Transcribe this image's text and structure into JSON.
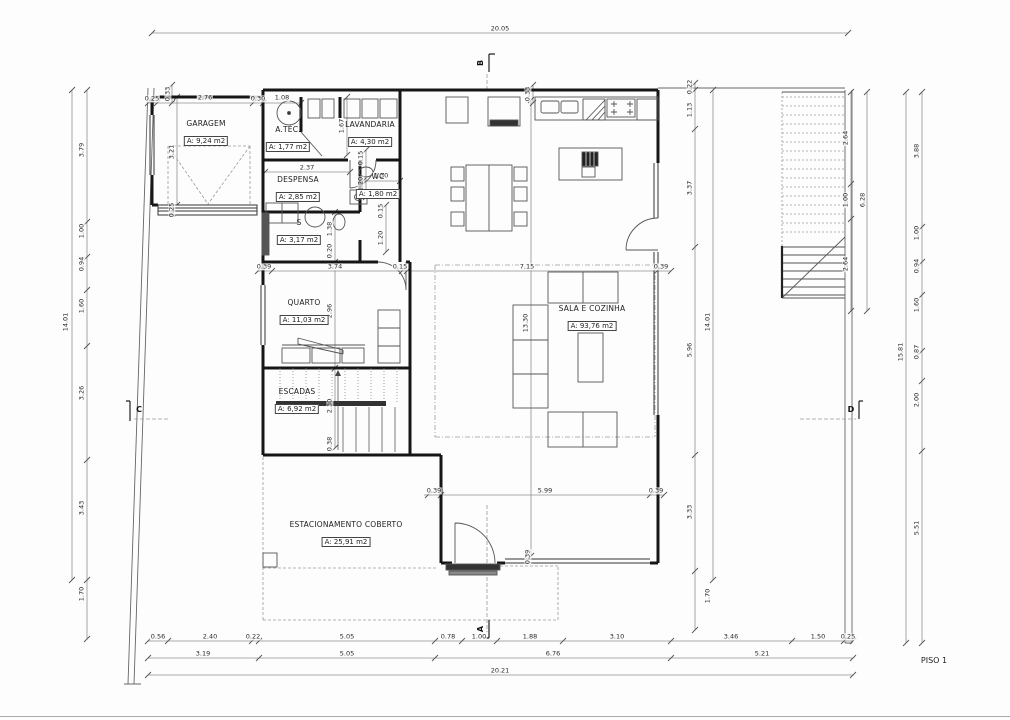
{
  "sheet": {
    "title": "PISO 1"
  },
  "drawing": {
    "rooms": [
      {
        "name": "GARAGEM",
        "area": "A: 9,24 m2",
        "x": 206,
        "y": 133
      },
      {
        "name": "A.TÉC.",
        "area": "A: 1,77 m2",
        "x": 288,
        "y": 139
      },
      {
        "name": "LAVANDARIA",
        "area": "A: 4,30 m2",
        "x": 370,
        "y": 134
      },
      {
        "name": "DESPENSA",
        "area": "A: 2,85 m2",
        "x": 298,
        "y": 189
      },
      {
        "name": "WC",
        "area": "A: 1,80 m2",
        "x": 378,
        "y": 186
      },
      {
        "name": "S",
        "area": "A: 3,17 m2",
        "x": 299,
        "y": 232
      },
      {
        "name": "QUARTO",
        "area": "A: 11,03 m2",
        "x": 304,
        "y": 312
      },
      {
        "name": "ESCADAS",
        "area": "A: 6,92 m2",
        "x": 297,
        "y": 401
      },
      {
        "name": "SALA E COZINHA",
        "area": "A: 93,76 m2",
        "x": 592,
        "y": 318
      },
      {
        "name": "ESTACIONAMENTO COBERTO",
        "area": "A: 25,91 m2",
        "x": 346,
        "y": 534
      }
    ],
    "dimensions": [
      {
        "t": "20.05",
        "x": 500,
        "y": 29
      },
      {
        "t": "0.25",
        "x": 152,
        "y": 99
      },
      {
        "t": "2.76",
        "x": 205,
        "y": 98
      },
      {
        "t": "0.30",
        "x": 258,
        "y": 99
      },
      {
        "t": "1.08",
        "x": 282,
        "y": 98
      },
      {
        "t": "0.33",
        "x": 168,
        "y": 94,
        "v": 1
      },
      {
        "t": "0.33",
        "x": 528,
        "y": 94,
        "v": 1
      },
      {
        "t": "0.22",
        "x": 690,
        "y": 87,
        "v": 1
      },
      {
        "t": "1.13",
        "x": 690,
        "y": 110,
        "v": 1
      },
      {
        "t": "3.37",
        "x": 690,
        "y": 188,
        "v": 1
      },
      {
        "t": "3.21",
        "x": 172,
        "y": 152,
        "v": 1
      },
      {
        "t": "0.25",
        "x": 172,
        "y": 210,
        "v": 1
      },
      {
        "t": "1.67",
        "x": 342,
        "y": 126,
        "v": 1
      },
      {
        "t": "2.37",
        "x": 307,
        "y": 168
      },
      {
        "t": "1.30",
        "x": 381,
        "y": 176
      },
      {
        "t": "0.15",
        "x": 361,
        "y": 158,
        "v": 1
      },
      {
        "t": "1.20",
        "x": 361,
        "y": 184,
        "v": 1
      },
      {
        "t": "0.15",
        "x": 381,
        "y": 211,
        "v": 1
      },
      {
        "t": "1.20",
        "x": 381,
        "y": 238,
        "v": 1
      },
      {
        "t": "1.38",
        "x": 330,
        "y": 229,
        "v": 1
      },
      {
        "t": "0.20",
        "x": 330,
        "y": 251,
        "v": 1
      },
      {
        "t": "0.39",
        "x": 264,
        "y": 267
      },
      {
        "t": "3.74",
        "x": 335,
        "y": 267
      },
      {
        "t": "0.15",
        "x": 400,
        "y": 267
      },
      {
        "t": "7.15",
        "x": 527,
        "y": 267
      },
      {
        "t": "0.39",
        "x": 661,
        "y": 267
      },
      {
        "t": "2.96",
        "x": 330,
        "y": 311,
        "v": 1
      },
      {
        "t": "13.30",
        "x": 526,
        "y": 323,
        "v": 1
      },
      {
        "t": "5.96",
        "x": 690,
        "y": 350,
        "v": 1
      },
      {
        "t": "14.01",
        "x": 708,
        "y": 322,
        "v": 1
      },
      {
        "t": "2.64",
        "x": 846,
        "y": 138,
        "v": 1
      },
      {
        "t": "1.00",
        "x": 846,
        "y": 200,
        "v": 1
      },
      {
        "t": "2.64",
        "x": 846,
        "y": 264,
        "v": 1
      },
      {
        "t": "6.28",
        "x": 863,
        "y": 200,
        "v": 1
      },
      {
        "t": "2.30",
        "x": 330,
        "y": 406,
        "v": 1
      },
      {
        "t": "0.38",
        "x": 330,
        "y": 444,
        "v": 1
      },
      {
        "t": "0.39",
        "x": 434,
        "y": 491
      },
      {
        "t": "5.99",
        "x": 545,
        "y": 491
      },
      {
        "t": "0.39",
        "x": 656,
        "y": 491
      },
      {
        "t": "0.39",
        "x": 528,
        "y": 557,
        "v": 1
      },
      {
        "t": "3.33",
        "x": 690,
        "y": 512,
        "v": 1
      },
      {
        "t": "1.70",
        "x": 708,
        "y": 596,
        "v": 1
      },
      {
        "t": "3.79",
        "x": 82,
        "y": 150,
        "v": 1
      },
      {
        "t": "1.00",
        "x": 82,
        "y": 231,
        "v": 1
      },
      {
        "t": "0.94",
        "x": 82,
        "y": 264,
        "v": 1
      },
      {
        "t": "1.60",
        "x": 82,
        "y": 306,
        "v": 1
      },
      {
        "t": "3.26",
        "x": 82,
        "y": 393,
        "v": 1
      },
      {
        "t": "3.43",
        "x": 82,
        "y": 508,
        "v": 1
      },
      {
        "t": "1.70",
        "x": 82,
        "y": 594,
        "v": 1
      },
      {
        "t": "14.01",
        "x": 66,
        "y": 322,
        "v": 1
      },
      {
        "t": "3.88",
        "x": 917,
        "y": 151,
        "v": 1
      },
      {
        "t": "1.00",
        "x": 917,
        "y": 233,
        "v": 1
      },
      {
        "t": "0.94",
        "x": 917,
        "y": 266,
        "v": 1
      },
      {
        "t": "1.60",
        "x": 917,
        "y": 305,
        "v": 1
      },
      {
        "t": "0.87",
        "x": 917,
        "y": 352,
        "v": 1
      },
      {
        "t": "2.00",
        "x": 917,
        "y": 400,
        "v": 1
      },
      {
        "t": "5.51",
        "x": 917,
        "y": 528,
        "v": 1
      },
      {
        "t": "15.81",
        "x": 901,
        "y": 352,
        "v": 1
      },
      {
        "t": "0.56",
        "x": 158,
        "y": 637
      },
      {
        "t": "2.40",
        "x": 210,
        "y": 637
      },
      {
        "t": "0.22",
        "x": 253,
        "y": 637
      },
      {
        "t": "5.05",
        "x": 347,
        "y": 637
      },
      {
        "t": "0.78",
        "x": 448,
        "y": 637
      },
      {
        "t": "1.00",
        "x": 479,
        "y": 637
      },
      {
        "t": "1.88",
        "x": 530,
        "y": 637
      },
      {
        "t": "3.10",
        "x": 617,
        "y": 637
      },
      {
        "t": "3.46",
        "x": 731,
        "y": 637
      },
      {
        "t": "1.50",
        "x": 818,
        "y": 637
      },
      {
        "t": "0.25",
        "x": 848,
        "y": 637
      },
      {
        "t": "3.19",
        "x": 203,
        "y": 654
      },
      {
        "t": "5.05",
        "x": 347,
        "y": 654
      },
      {
        "t": "6.76",
        "x": 553,
        "y": 654
      },
      {
        "t": "5.21",
        "x": 762,
        "y": 654
      },
      {
        "t": "20.21",
        "x": 500,
        "y": 671
      }
    ],
    "section_markers": [
      {
        "label": "B",
        "x": 481,
        "y": 63,
        "rot": 1
      },
      {
        "label": "A",
        "x": 481,
        "y": 629,
        "rot": 1
      },
      {
        "label": "C",
        "x": 139,
        "y": 410,
        "rot": 0
      },
      {
        "label": "D",
        "x": 851,
        "y": 410,
        "rot": 0
      }
    ]
  }
}
